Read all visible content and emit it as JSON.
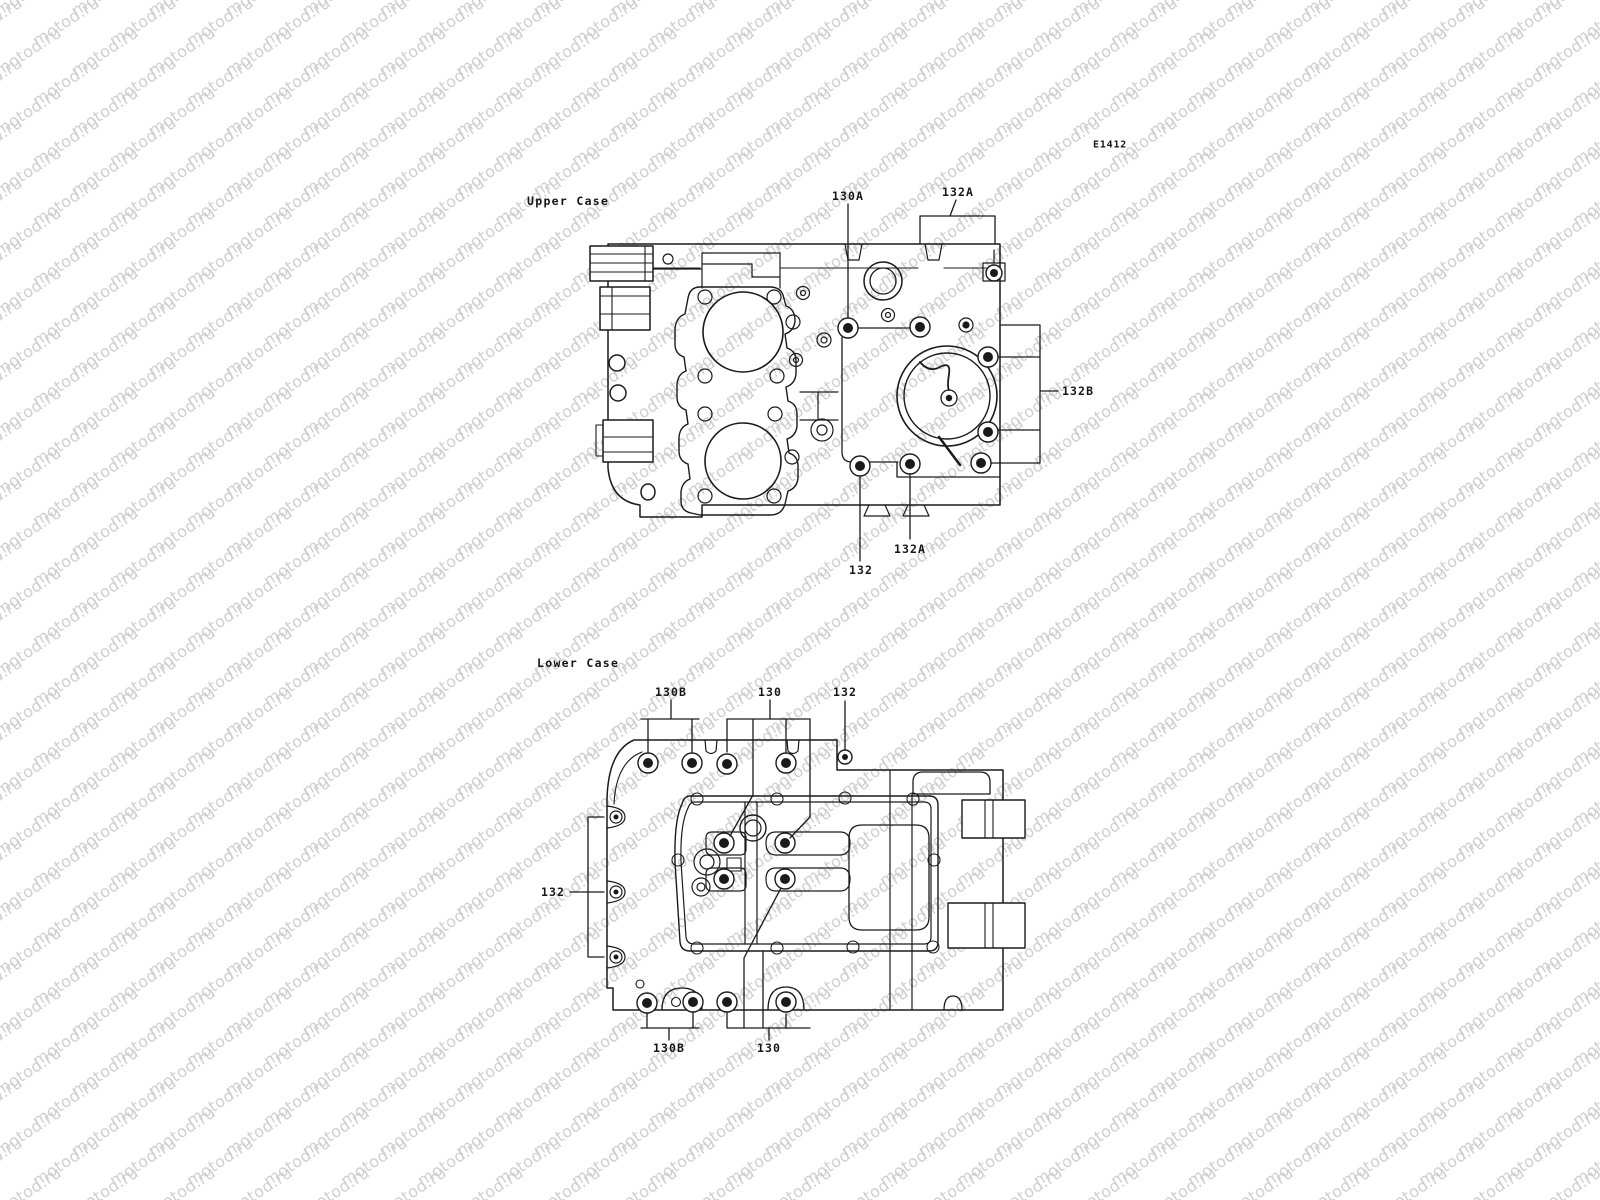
{
  "page": {
    "code": "E1412",
    "watermark_text": "motod.ru",
    "colors": {
      "background": "#ffffff",
      "line": "#1a1a1a",
      "watermark": "#cfcfcf",
      "text": "#161616"
    }
  },
  "upper_case": {
    "title": "Upper Case",
    "callouts": {
      "top_130A": "130A",
      "top_132A": "132A",
      "right_132B": "132B",
      "bottom_132A": "132A",
      "bottom_132": "132"
    }
  },
  "lower_case": {
    "title": "Lower Case",
    "callouts": {
      "top_130B": "130B",
      "top_130": "130",
      "top_132": "132",
      "left_132": "132",
      "bottom_130B": "130B",
      "bottom_130": "130"
    }
  }
}
